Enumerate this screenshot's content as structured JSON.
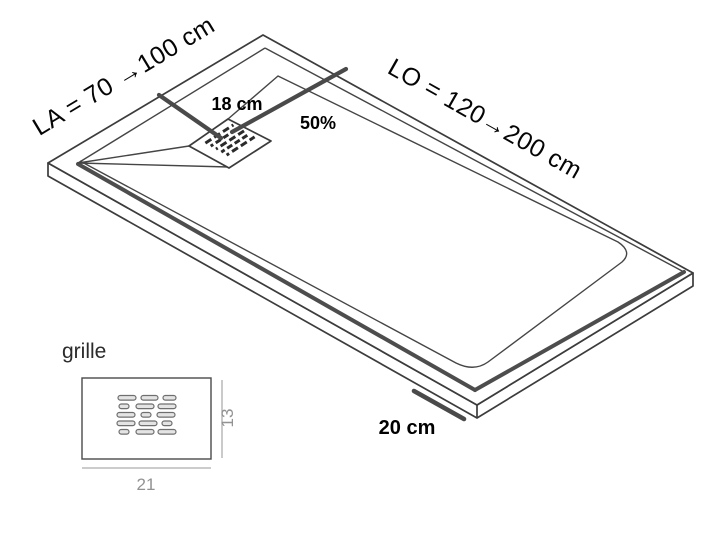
{
  "diagram": {
    "labels": {
      "width_range": "LA = 70 →100 cm",
      "length_range": "LO = 120→200 cm",
      "drain_offset": "18 cm",
      "slope": "50%",
      "corner_dimension": "20 cm"
    },
    "grille_detail": {
      "title": "grille",
      "width": "21",
      "height": "13"
    },
    "colors": {
      "outline": "#3c3c3c",
      "dimension_line": "#4a4a4a",
      "label_text": "#000000",
      "detail_dimension_gray": "#929292"
    }
  }
}
